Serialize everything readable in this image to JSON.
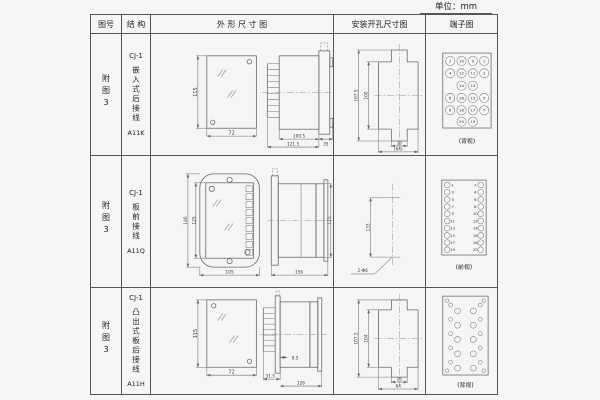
{
  "unit_label": "单位：mm",
  "header": {
    "fig": "图号",
    "struct": "结 构",
    "outline": "外 形 尺 寸 图",
    "mount": "安装开孔尺寸图",
    "terminal": "端子图"
  },
  "rows": [
    {
      "fig_no": "附图3",
      "model": "CJ-1",
      "desc": "嵌入式后接线",
      "code": "A11K",
      "outline": {
        "front_h": "115",
        "front_w": "72",
        "body_l": "100.5",
        "total_l": "121.5",
        "flange_l": "35"
      },
      "mount": {
        "outer_h": "107.5",
        "inner_h": "100",
        "notch_w": "16",
        "cut_w": "(64)"
      },
      "terminal": {
        "caption": "(背视)",
        "grid": [
          [
            "2",
            "10",
            "9",
            "1"
          ],
          [
            "4",
            "12",
            "11",
            "3"
          ],
          [
            "14",
            "13"
          ],
          [
            "6",
            "16",
            "15",
            "5"
          ],
          [
            "8",
            "18",
            "17",
            "7"
          ],
          [
            "20",
            "19"
          ]
        ]
      }
    },
    {
      "fig_no": "附图3",
      "model": "CJ-1",
      "desc": "板前接线",
      "code": "A11Q",
      "outline": {
        "front_outer_h": "140",
        "front_inner_h": "125",
        "front_w": "105",
        "side_l": "156",
        "side_h": "115"
      },
      "mount": {
        "hole_span": "133",
        "hole_label": "2-Φ6"
      },
      "terminal": {
        "caption": "(前视)",
        "left": [
          "1",
          "3",
          "5",
          "7",
          "9",
          "11",
          "13",
          "15",
          "17",
          "19"
        ],
        "right": [
          "2",
          "4",
          "6",
          "8",
          "10",
          "12",
          "14",
          "16",
          "18",
          "20"
        ]
      }
    },
    {
      "fig_no": "附图3",
      "model": "CJ-1",
      "desc": "凸出式板后接线",
      "code": "A11H",
      "outline": {
        "front_h": "115",
        "front_w": "72",
        "stud_l": "31.5",
        "gap": "9.5",
        "body_l": "126"
      },
      "mount": {
        "outer_h": "107.5",
        "inner_h": "104",
        "notch_w": "16",
        "cut_w": "64"
      },
      "terminal": {
        "caption": "(背视)"
      }
    }
  ]
}
